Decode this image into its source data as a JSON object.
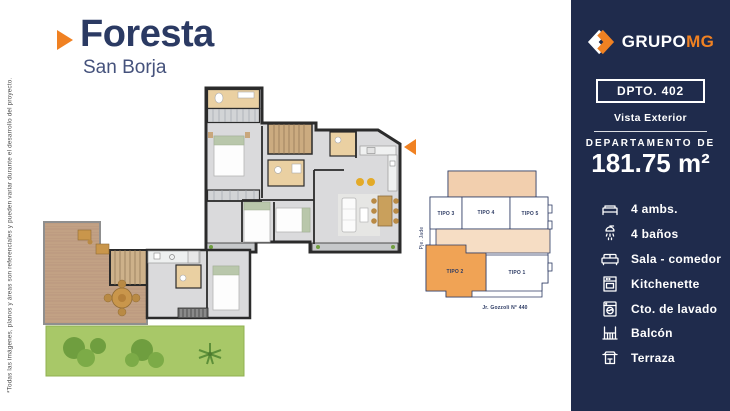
{
  "disclaimer": "*Todas las imágenes, planos y áreas son referenciales y pueden variar durante el desarrollo del proyecto.",
  "header": {
    "title": "Foresta",
    "subtitle": "San Borja"
  },
  "keyplan": {
    "units": [
      {
        "label": "TIPO 3",
        "highlighted": false
      },
      {
        "label": "TIPO 4",
        "highlighted": false
      },
      {
        "label": "TIPO 5",
        "highlighted": false
      },
      {
        "label": "TIPO 2",
        "highlighted": true
      },
      {
        "label": "TIPO 1",
        "highlighted": false
      }
    ],
    "street_bottom": "Jr. Gozzoli N° 440",
    "street_left": "Pje. Jade"
  },
  "sidebar": {
    "brand": {
      "name_primary": "GRUPO",
      "name_secondary": "MG"
    },
    "unit_badge": "DPTO. 402",
    "view_label": "Vista Exterior",
    "area_title": "DEPARTAMENTO DE",
    "area_value": "181.75 m²",
    "features": [
      {
        "icon": "bed-icon",
        "label": "4 ambs."
      },
      {
        "icon": "shower-icon",
        "label": "4 baños"
      },
      {
        "icon": "sofa-icon",
        "label": "Sala - comedor"
      },
      {
        "icon": "kitchenette-icon",
        "label": "Kitchenette"
      },
      {
        "icon": "laundry-icon",
        "label": "Cto. de lavado"
      },
      {
        "icon": "balcony-icon",
        "label": "Balcón"
      },
      {
        "icon": "terrace-icon",
        "label": "Terraza"
      }
    ]
  },
  "colors": {
    "accent": "#f08122",
    "navy": "#1f2b4c",
    "title_text": "#2b3a63",
    "subtitle_text": "#45527c",
    "disclaimer_text": "#4f4f4f",
    "plan_wall": "#2b2b2b",
    "plan_floor": "#dadadc",
    "plan_wood": "#c2a184",
    "plan_bath": "#ead0a2",
    "garden_green": "#a8c868",
    "keyplan_line": "#2c3a63",
    "keyplan_peach": "#f2cfae",
    "keyplan_peach_light": "#f6ddc4",
    "keyplan_orange": "#f0a355"
  }
}
